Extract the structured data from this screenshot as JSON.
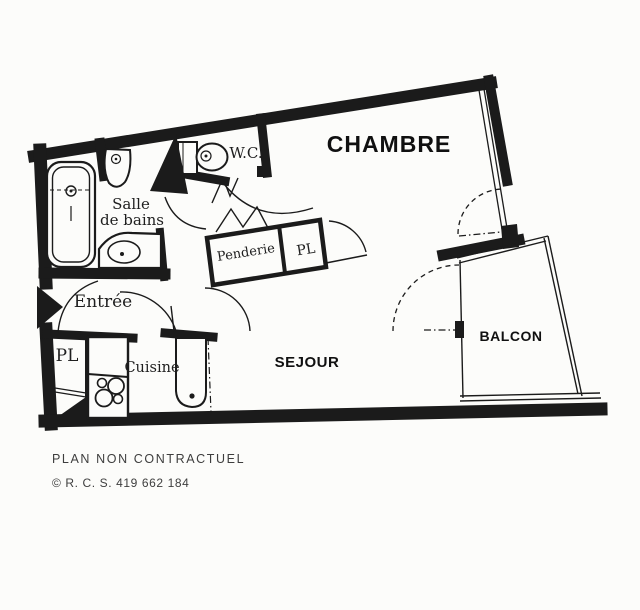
{
  "page": {
    "paper_color": "#fcfcfa",
    "ink_color": "#1b1b1b"
  },
  "plan": {
    "rooms": {
      "chambre": "CHAMBRE",
      "wc": "W.C.",
      "salle_de_bains_line1": "Salle",
      "salle_de_bains_line2": "de bains",
      "penderie": "Penderie",
      "placard_upper": "PL",
      "entree": "Entrée",
      "placard_lower": "PL",
      "cuisine": "Cuisine",
      "sejour": "SEJOUR",
      "balcon": "BALCON"
    }
  },
  "footer": {
    "disclaimer": "PLAN NON CONTRACTUEL",
    "registration": "© R. C. S. 419 662 184"
  }
}
